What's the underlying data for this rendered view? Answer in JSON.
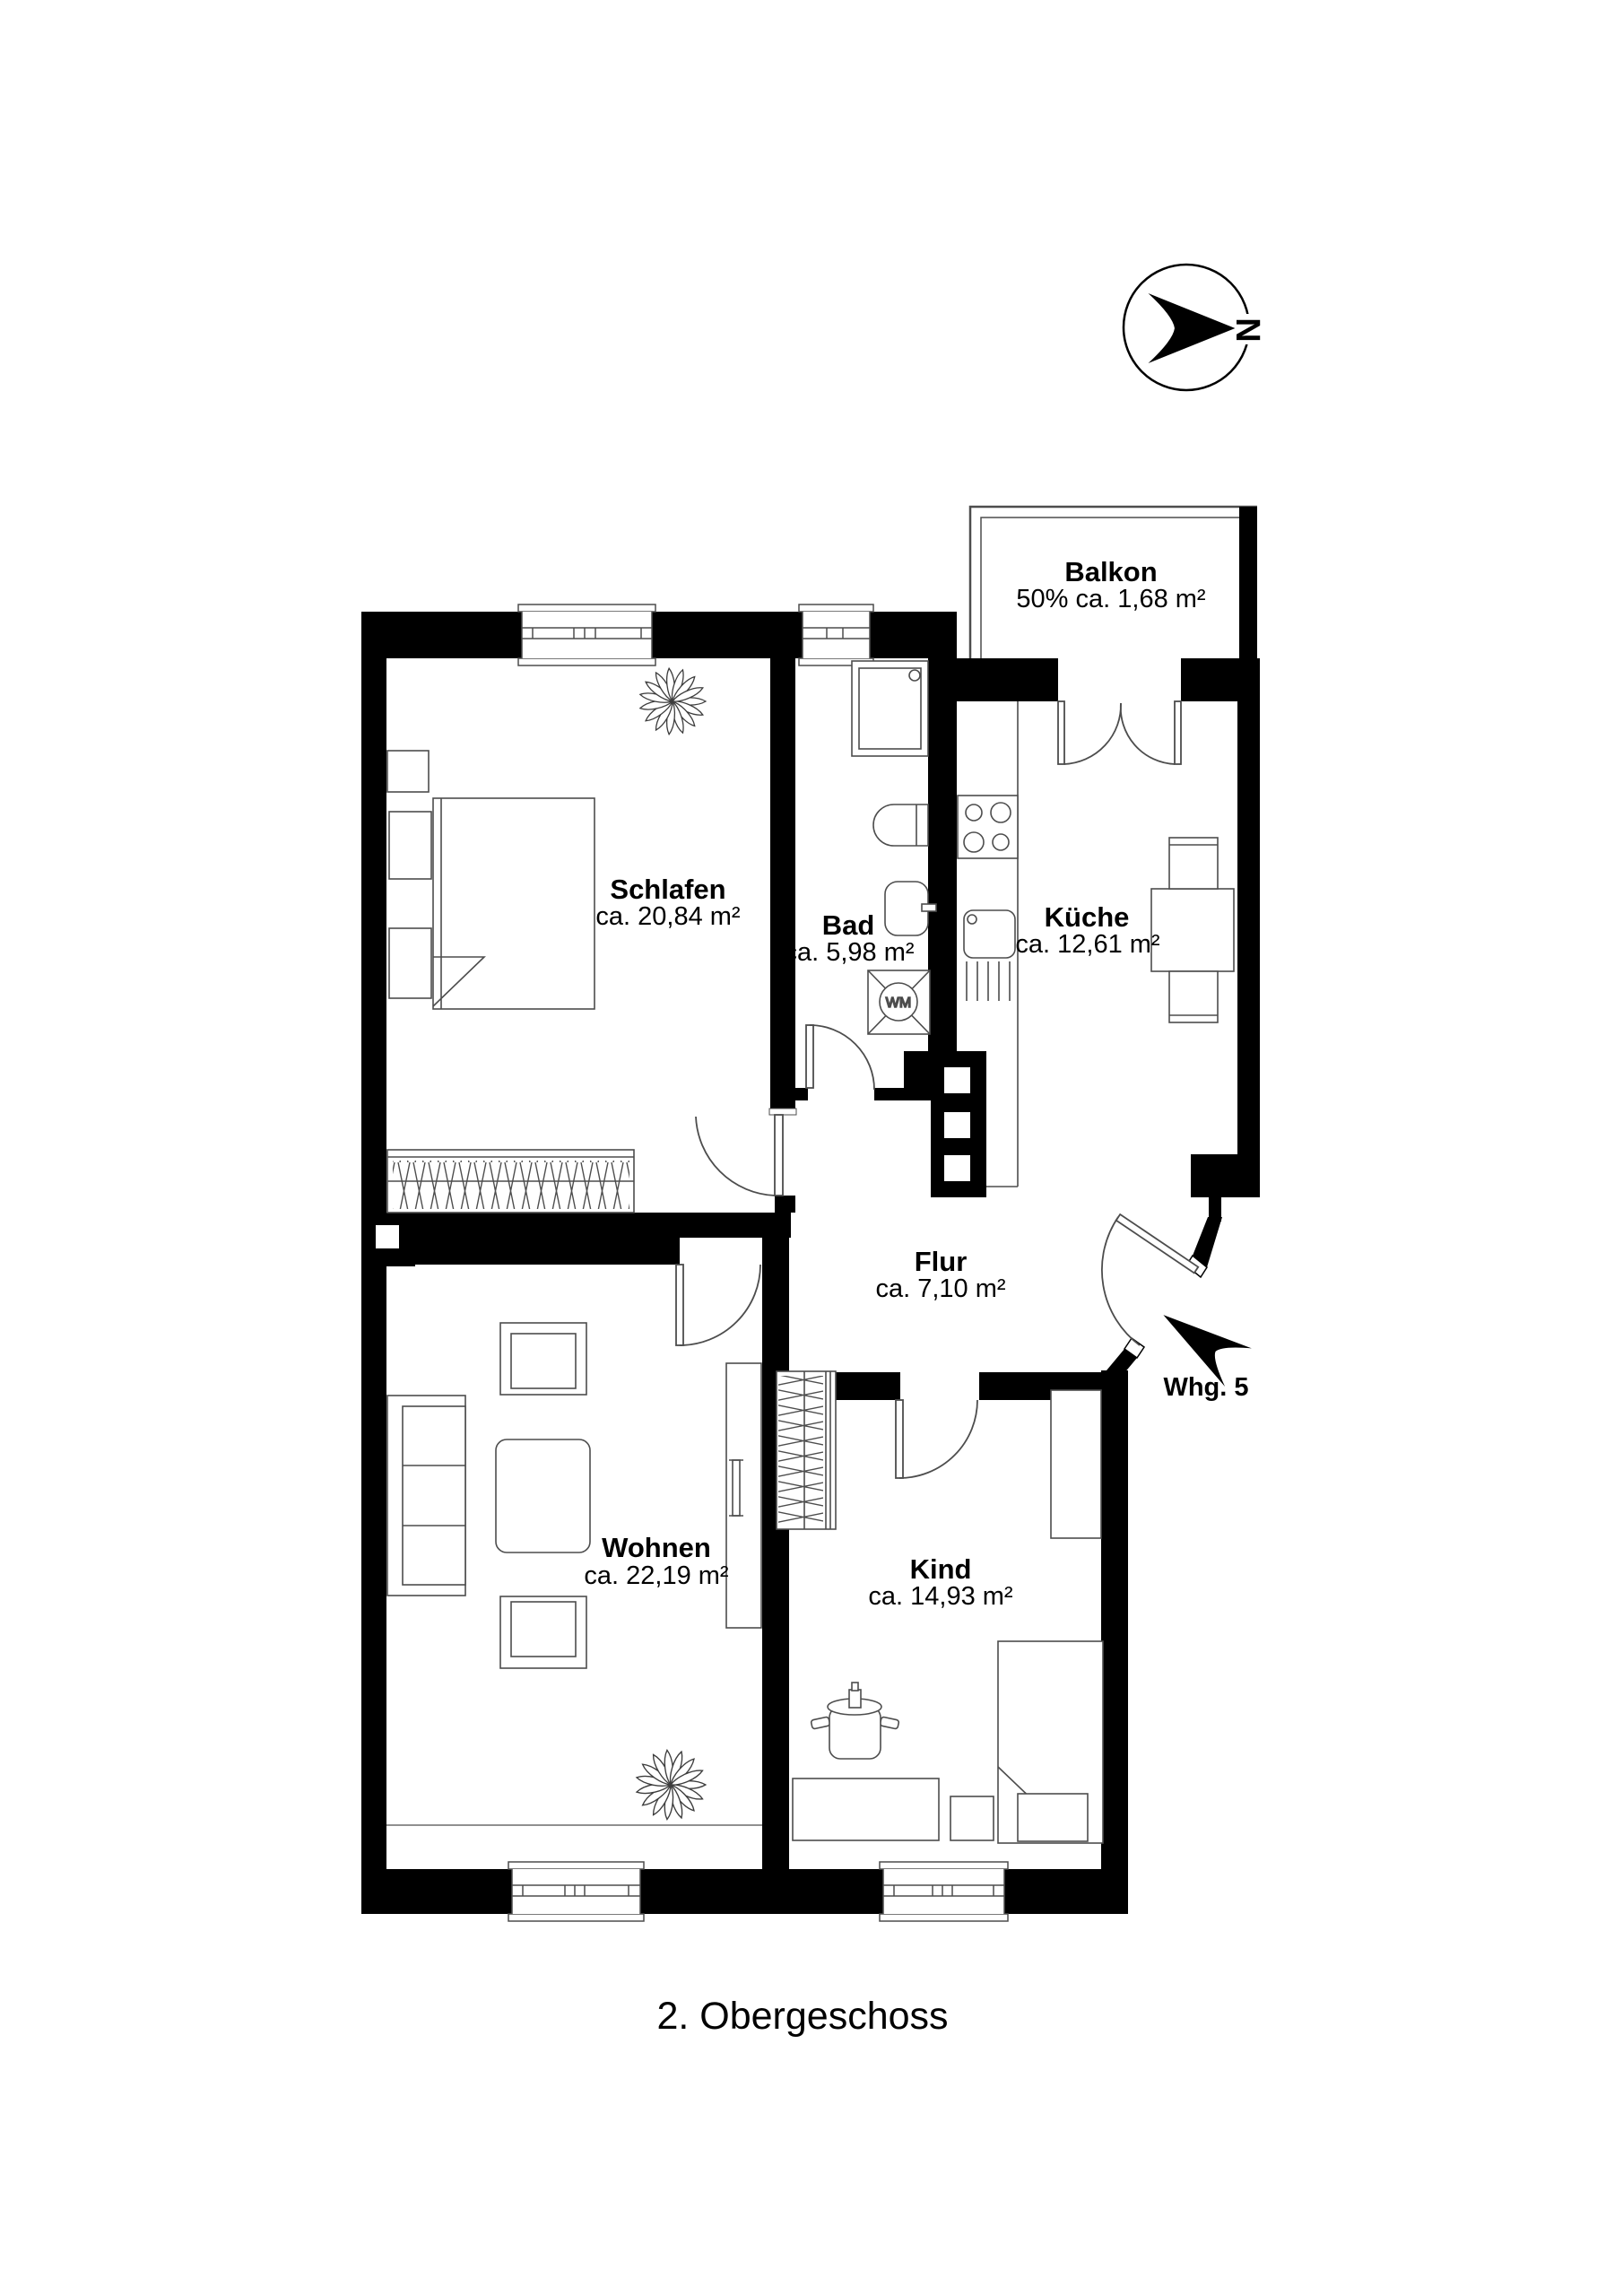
{
  "caption": "2. Obergeschoss",
  "compass": {
    "north_label": "N"
  },
  "entrance": {
    "label": "Whg. 5"
  },
  "rooms": {
    "balkon": {
      "name": "Balkon",
      "area": "50% ca. 1,68 m²"
    },
    "schlafen": {
      "name": "Schlafen",
      "area": "ca. 20,84 m²"
    },
    "bad": {
      "name": "Bad",
      "area": "ca. 5,98 m²"
    },
    "kueche": {
      "name": "Küche",
      "area": "ca. 12,61 m²"
    },
    "flur": {
      "name": "Flur",
      "area": "ca. 7,10 m²"
    },
    "wohnen": {
      "name": "Wohnen",
      "area": "ca. 22,19 m²"
    },
    "kind": {
      "name": "Kind",
      "area": "ca. 14,93 m²"
    }
  },
  "appliances": {
    "washing_machine": "WM"
  },
  "colors": {
    "wall": "#000000",
    "furniture_line": "#4d4d4d",
    "background": "#ffffff"
  }
}
